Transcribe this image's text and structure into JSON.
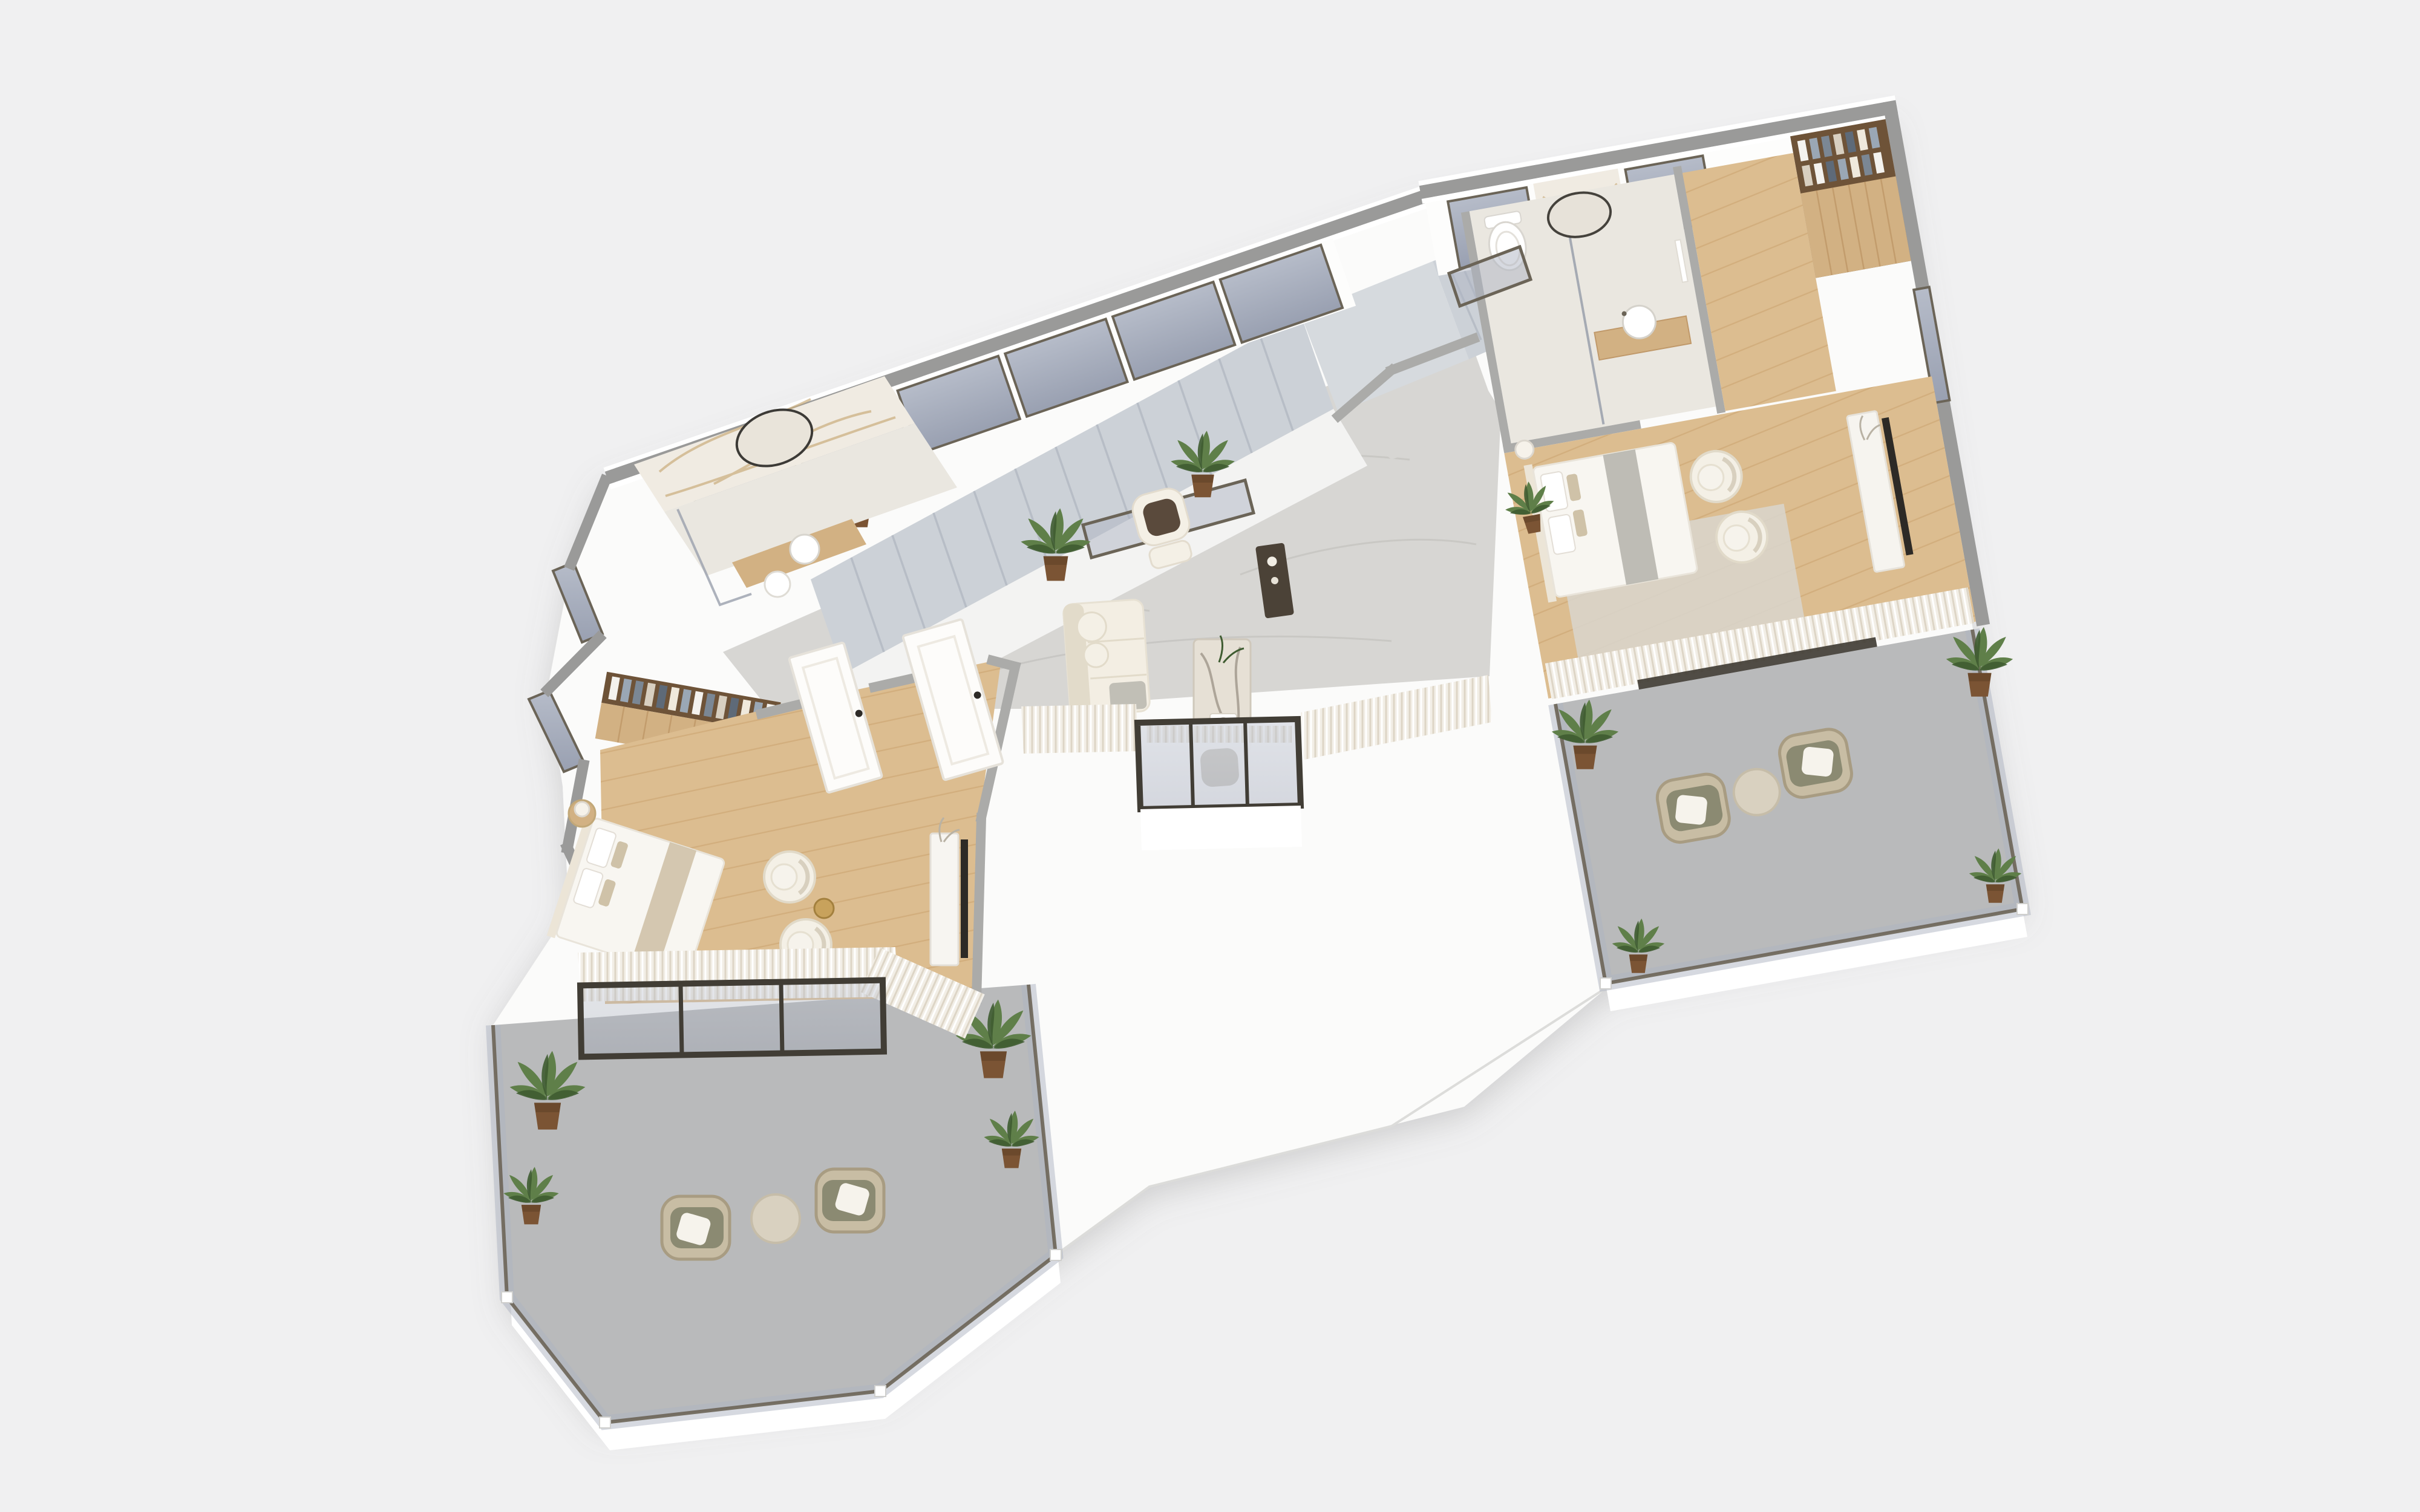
{
  "scene": {
    "description": "Isometric 3D cutaway render of a modern two-bedroom apartment floor plan",
    "view": "top-down axonometric, cut walls shown as gray caps",
    "background": "#f0f0f1"
  },
  "colors": {
    "background": "#f0f0f1",
    "silhouette": "#fbfbfa",
    "wall_cap": "#9a9a99",
    "wall_int": "#ababa9",
    "wall_white": "#fdfdfc",
    "shadow_line": "#dcdcda",
    "marble_floor": "#d7d6d3",
    "marble_vein": "#c3c2be",
    "stone_floor": "#eae7e0",
    "wood_floor": "#dcbd90",
    "plank_line": "#c49a66",
    "wood_slat": "#d2b183",
    "wood_dark": "#b98f5e",
    "balcony_tile": "#b9babb",
    "glass_top": "#b6bcc9",
    "glass_bottom": "#99a0b1",
    "glass_rail": "#aeb4c2",
    "frame_bronze": "#6b6457",
    "frame_dark": "#413d35",
    "curtain": "#f2eee6",
    "curtain_shadow": "#ddd5c6",
    "stair": "#ccd1d7",
    "stair_edge": "#b7bdc6",
    "stair_landing": "#d6dade",
    "understair": "#f3f3f2",
    "sofa": "#f3eee3",
    "sofa_line": "#e2dbca",
    "cushion_brown": "#5a4a3c",
    "chair_cream": "#f4f0e6",
    "rattan": "#c8bda4",
    "rattan_dark": "#a89c82",
    "olive": "#8b8a72",
    "pillow_white": "#f6f3ec",
    "table_marble": "#e6e0d5",
    "table_vein": "#8f867a",
    "travertine": "#d9d1c0",
    "sideboard": "#4b4237",
    "tv_dark": "#2d2a26",
    "bed_white": "#f8f6f1",
    "headboard": "#ece5d7",
    "throw_gray": "#b7b6ae",
    "throw_knit": "#cfc2a8",
    "rug": "#d9d6ce",
    "marble_wall": "#f0ebe2",
    "marble_wall_vein": "#c9ad7c",
    "closet_interior": "#6e5338",
    "plant": "#5f7f49",
    "plant_dark": "#3f5c31",
    "pot": "#7b5434",
    "pot_dark": "#5f3f26",
    "lamp": "#f6f2ea",
    "brass": "#c8a25c"
  },
  "rooms": [
    {
      "name": "Staircase hall",
      "floor": "marble",
      "features": [
        "long flight along glazed north wall",
        "upper landing",
        "short return flight",
        "glass balustrade"
      ]
    },
    {
      "name": "Living room",
      "floor": "marble",
      "furniture": [
        "cream sofa",
        "marble coffee table",
        "cream lounge chair",
        "dark sideboard",
        "potted plants"
      ]
    },
    {
      "name": "Bay window nook",
      "features": [
        "projecting glazed box",
        "window seat"
      ]
    },
    {
      "name": "Master bathroom",
      "floor": "stone",
      "furniture": [
        "marble feature wall",
        "oval mirror",
        "vanity basin",
        "stool",
        "glass shower screen"
      ]
    },
    {
      "name": "Master wardrobe",
      "furniture": [
        "open closet with hanging clothes",
        "slatted wood doors"
      ]
    },
    {
      "name": "Master bedroom",
      "floor": "oak",
      "furniture": [
        "double bed",
        "bedside lamp",
        "two cream lounge chairs",
        "brass side table",
        "TV console"
      ]
    },
    {
      "name": "Master balcony",
      "floor": "concrete tile",
      "furniture": [
        "two rattan armchairs",
        "travertine side table",
        "four potted plants",
        "glass railing"
      ]
    },
    {
      "name": "Bedroom 2",
      "floor": "oak",
      "furniture": [
        "double bed",
        "two cream lounge chairs",
        "TV console",
        "rug",
        "potted plant"
      ]
    },
    {
      "name": "Bathroom 2",
      "floor": "stone",
      "furniture": [
        "toilet",
        "oval mirror",
        "round basin on slatted vanity",
        "glass partition"
      ]
    },
    {
      "name": "Wardrobe corridor",
      "floor": "oak",
      "furniture": [
        "open closet with hanging clothes"
      ]
    },
    {
      "name": "Bedroom 2 balcony",
      "floor": "concrete tile",
      "furniture": [
        "two rattan armchairs",
        "travertine side table",
        "four potted plants",
        "glass railing"
      ]
    }
  ],
  "counts": {
    "potted_plants": 13,
    "balconies": 2,
    "bathrooms": 2,
    "bedrooms": 2,
    "doors_white": 3,
    "north_windows": 6
  }
}
